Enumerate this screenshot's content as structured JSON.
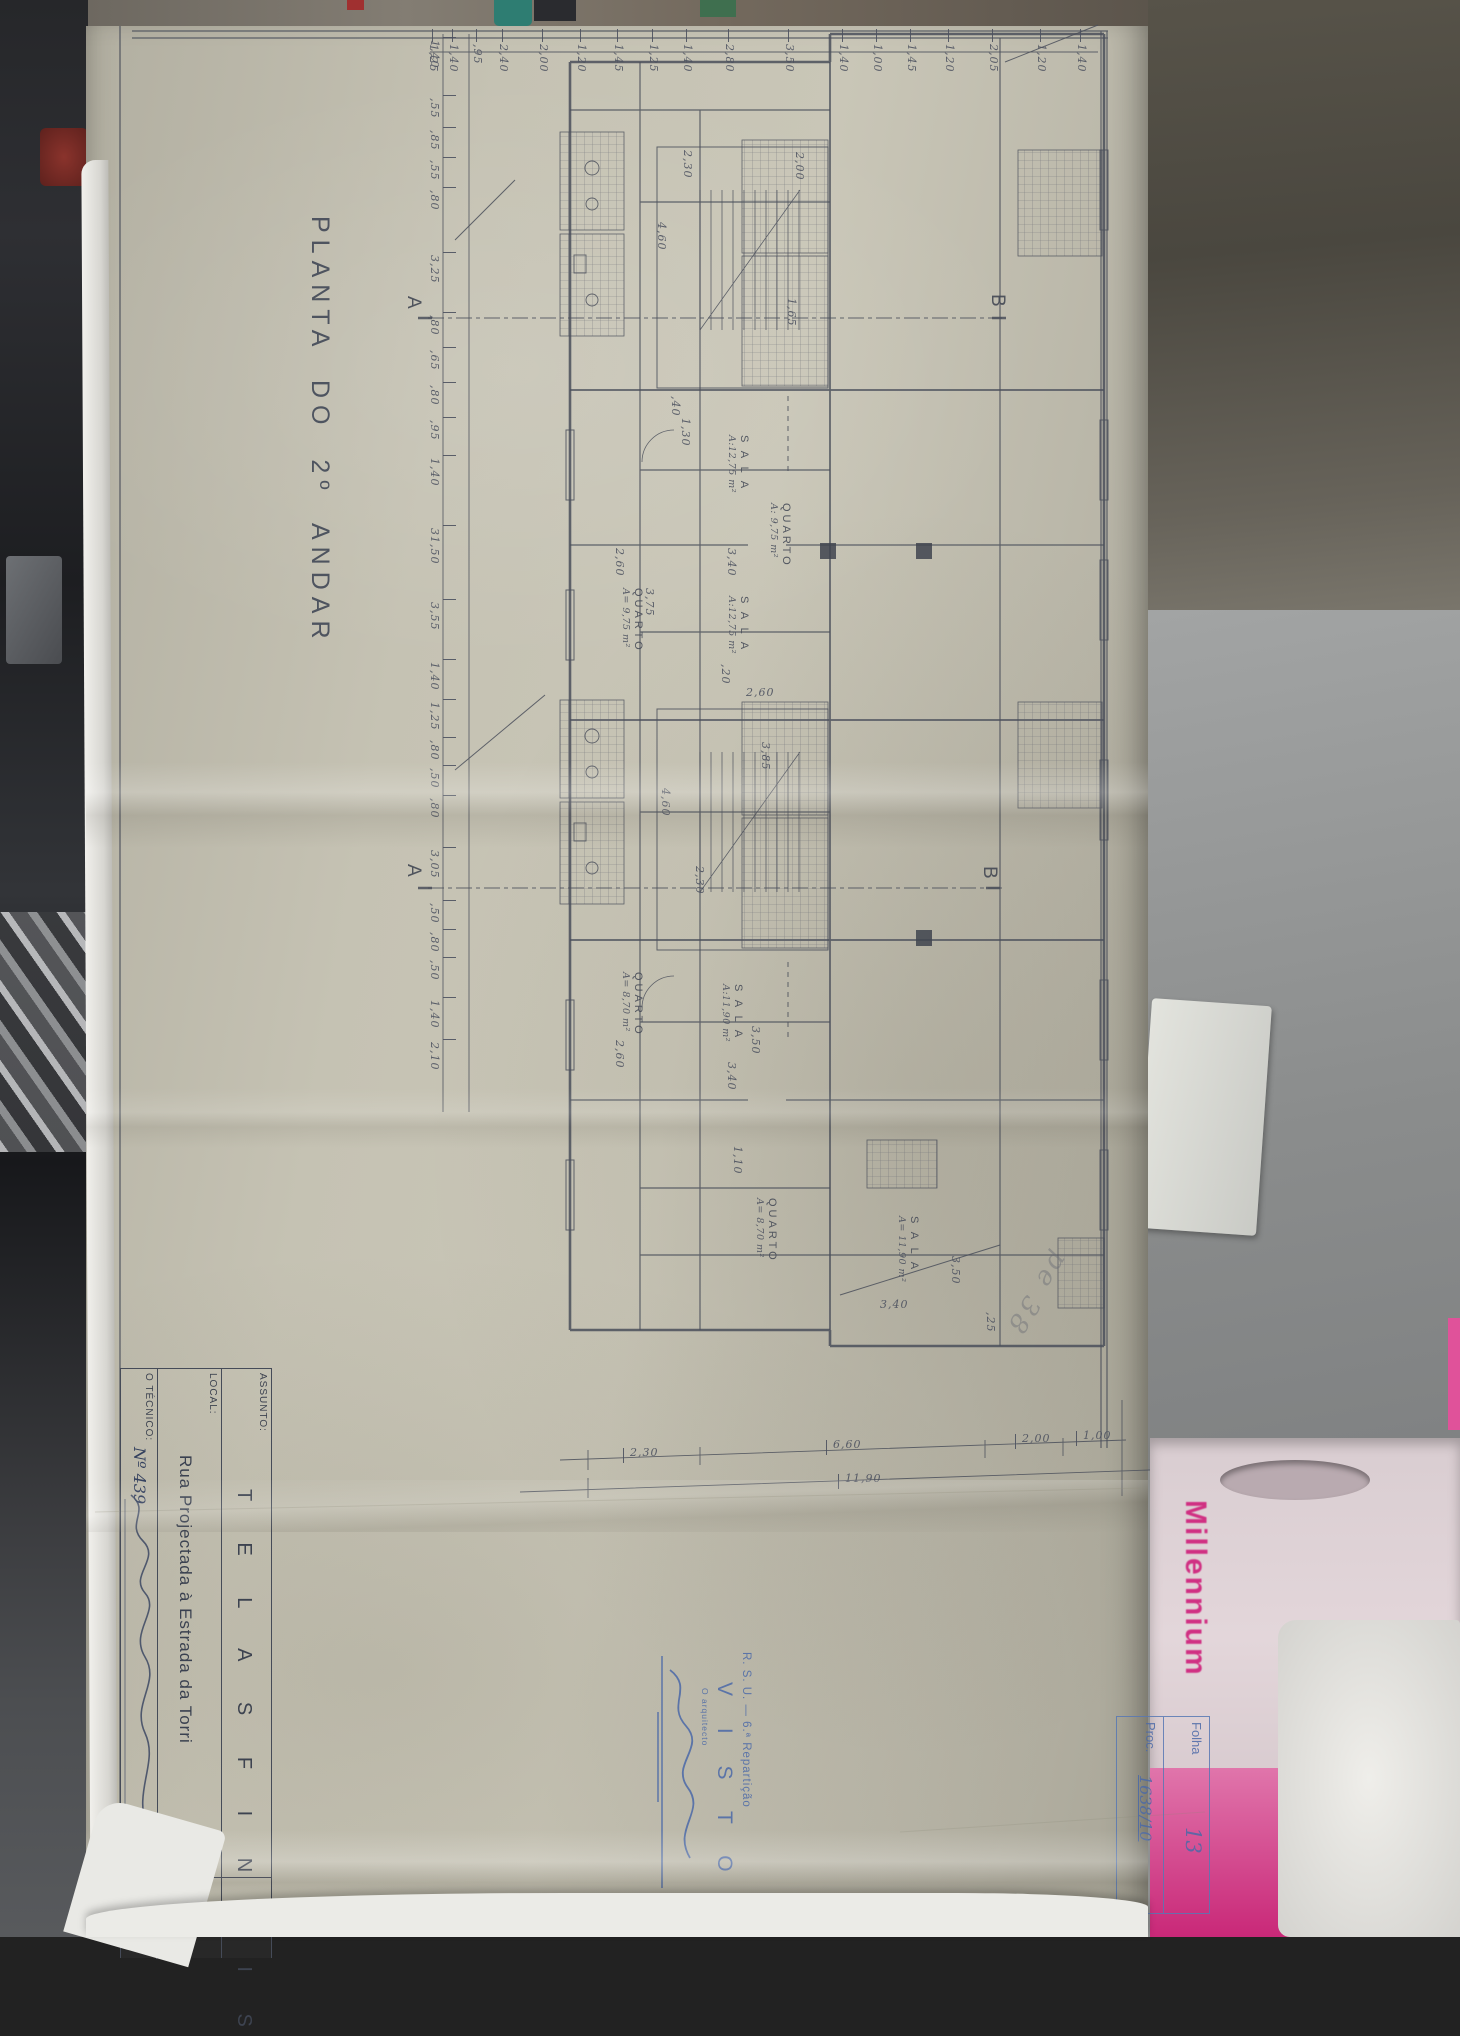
{
  "photo": {
    "bag_text": "Millennium"
  },
  "drawing": {
    "title": "PLANTA DO 2º ANDAR",
    "section_markers": [
      {
        "t": "A",
        "x": 424,
        "y": 296
      },
      {
        "t": "B",
        "x": 1008,
        "y": 294
      },
      {
        "t": "A",
        "x": 424,
        "y": 864
      },
      {
        "t": "B",
        "x": 1000,
        "y": 866
      }
    ],
    "rooms": [
      {
        "name": "S A L A",
        "area": "A:12,75 m²",
        "x": 750,
        "y": 435
      },
      {
        "name": "QUARTO",
        "area": "A: 9,75 m²",
        "x": 792,
        "y": 503
      },
      {
        "name": "QUARTO",
        "area": "A= 9,75 m²",
        "x": 644,
        "y": 588
      },
      {
        "name": "S A L A",
        "area": "A:12,75 m²",
        "x": 750,
        "y": 596
      },
      {
        "name": "QUARTO",
        "area": "A= 8,70 m²",
        "x": 644,
        "y": 972
      },
      {
        "name": "S A L A",
        "area": "A:11,90 m²",
        "x": 744,
        "y": 984
      },
      {
        "name": "QUARTO",
        "area": "A= 8,70 m²",
        "x": 778,
        "y": 1198
      },
      {
        "name": "S A L A",
        "area": "A= 11,90 m²",
        "x": 920,
        "y": 1216
      }
    ],
    "dims_small": [
      {
        "t": "2,30",
        "x": 694,
        "y": 150
      },
      {
        "t": "4,60",
        "x": 668,
        "y": 222
      },
      {
        "t": "2,00",
        "x": 806,
        "y": 152
      },
      {
        "t": "1,65",
        "x": 798,
        "y": 298
      },
      {
        "t": ",40",
        "x": 682,
        "y": 396
      },
      {
        "t": "1,30",
        "x": 692,
        "y": 418
      },
      {
        "t": "2,60",
        "x": 626,
        "y": 548
      },
      {
        "t": "3,40",
        "x": 738,
        "y": 548
      },
      {
        "t": "3,75",
        "x": 656,
        "y": 588
      },
      {
        "t": ",20",
        "x": 732,
        "y": 664
      },
      {
        "t": "2,60",
        "x": 746,
        "y": 686,
        "h": 1
      },
      {
        "t": "3,85",
        "x": 772,
        "y": 742
      },
      {
        "t": "4,60",
        "x": 672,
        "y": 788
      },
      {
        "t": "2,30",
        "x": 706,
        "y": 866
      },
      {
        "t": "2,60",
        "x": 626,
        "y": 1040
      },
      {
        "t": "3,50",
        "x": 762,
        "y": 1026
      },
      {
        "t": "3,40",
        "x": 738,
        "y": 1062
      },
      {
        "t": "1,10",
        "x": 744,
        "y": 1146
      },
      {
        "t": "3,50",
        "x": 962,
        "y": 1256
      },
      {
        "t": ",25",
        "x": 997,
        "y": 1312
      },
      {
        "t": "3,40",
        "x": 880,
        "y": 1298,
        "h": 1
      }
    ],
    "top_chain": {
      "y": 44,
      "items": [
        {
          "t": "1,25",
          "x": 440
        },
        {
          "t": "1,40",
          "x": 460
        },
        {
          "t": ",95",
          "x": 484
        },
        {
          "t": "2,40",
          "x": 510
        },
        {
          "t": "2,00",
          "x": 550
        },
        {
          "t": "1,20",
          "x": 588
        },
        {
          "t": "1,45",
          "x": 625
        },
        {
          "t": "1,25",
          "x": 660
        },
        {
          "t": "1,40",
          "x": 694
        },
        {
          "t": "2,80",
          "x": 736
        },
        {
          "t": "3,50",
          "x": 796
        },
        {
          "t": "1,40",
          "x": 850
        },
        {
          "t": "1,00",
          "x": 884
        },
        {
          "t": "1,45",
          "x": 918
        },
        {
          "t": "1,20",
          "x": 956
        },
        {
          "t": "2,05",
          "x": 1000
        },
        {
          "t": "1,20",
          "x": 1048
        },
        {
          "t": "1,40",
          "x": 1088
        }
      ]
    },
    "left_chain": {
      "x": 441,
      "items": [
        {
          "t": "1,40",
          "y": 40
        },
        {
          "t": ",55",
          "y": 98
        },
        {
          "t": ",85",
          "y": 130
        },
        {
          "t": ",55",
          "y": 160
        },
        {
          "t": ",80",
          "y": 190
        },
        {
          "t": "3,25",
          "y": 255
        },
        {
          "t": ",80",
          "y": 315
        },
        {
          "t": ",65",
          "y": 350
        },
        {
          "t": ",80",
          "y": 385
        },
        {
          "t": ",95",
          "y": 420
        },
        {
          "t": "1,40",
          "y": 458
        },
        {
          "t": "31,50",
          "y": 528
        },
        {
          "t": "3,55",
          "y": 602
        },
        {
          "t": "1,40",
          "y": 662
        },
        {
          "t": "1,25",
          "y": 702
        },
        {
          "t": ",80",
          "y": 740
        },
        {
          "t": ",50",
          "y": 768
        },
        {
          "t": ",80",
          "y": 798
        },
        {
          "t": "3,05",
          "y": 850
        },
        {
          "t": ",50",
          "y": 903
        },
        {
          "t": ",80",
          "y": 932
        },
        {
          "t": ",50",
          "y": 960
        },
        {
          "t": "1,40",
          "y": 1000
        },
        {
          "t": "2,10",
          "y": 1042
        }
      ]
    },
    "bottom_chain": {
      "items": [
        {
          "t": "2,30",
          "x": 630,
          "y": 1446
        },
        {
          "t": "6,60",
          "x": 833,
          "y": 1438
        },
        {
          "t": "2,00",
          "x": 1022,
          "y": 1432
        },
        {
          "t": "1,00",
          "x": 1083,
          "y": 1429
        },
        {
          "t": "11,90",
          "x": 845,
          "y": 1472
        }
      ]
    }
  },
  "title_block": {
    "assunto_label": "ASSUNTO:",
    "assunto_value": "T E L A S   F I N A I S",
    "local_label": "LOCAL:",
    "local_value": "Rua Projectada à Estrada da Torri",
    "tecnico_label": "O TÉCNICO:",
    "tecnico_number": "Nº 439",
    "corner_cell": "PL"
  },
  "stamps": {
    "folha_label": "Folha",
    "folha_value": "13",
    "proc_label": "Proc.",
    "proc_value": "1638/10",
    "rsu_line": "R. S. U. — 6.ª Repartição",
    "visto": "V I S T O",
    "arquitecto": "O arquitecto",
    "pencil_note": "pe 38"
  }
}
